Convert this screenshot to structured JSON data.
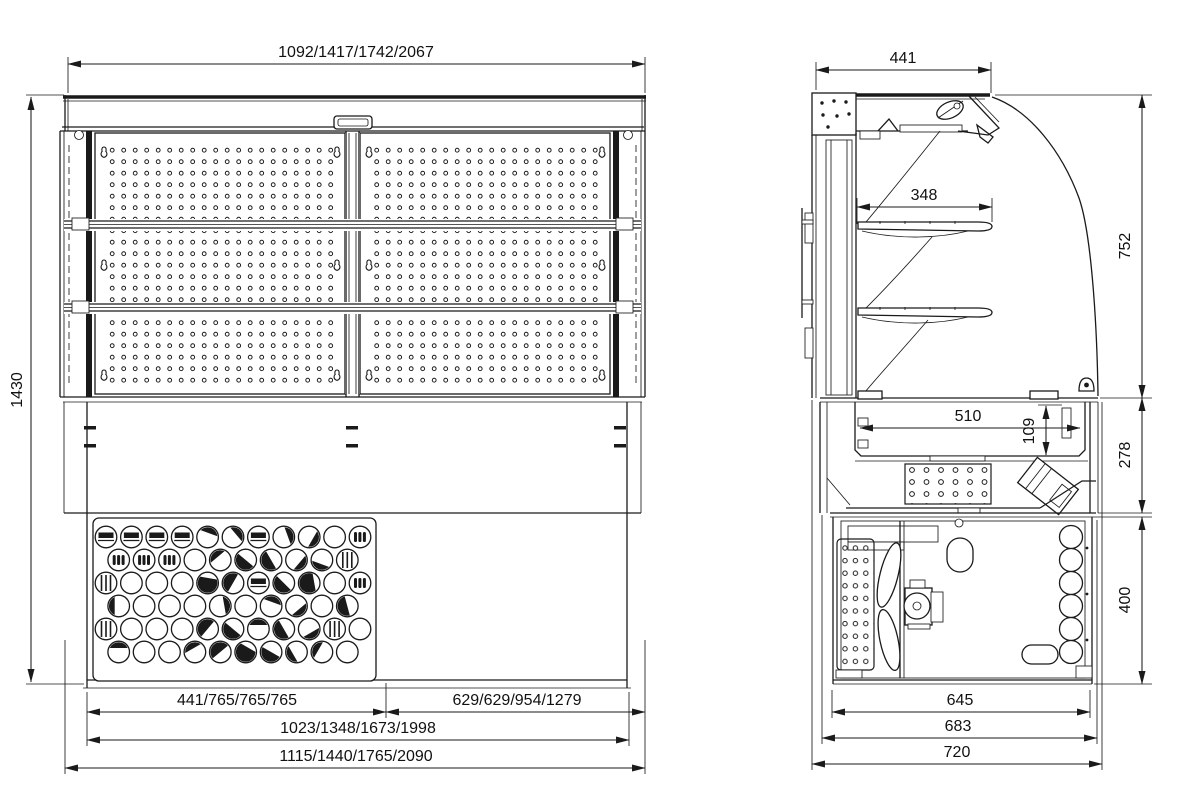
{
  "drawing": {
    "type": "technical-dimension-drawing",
    "subject": "refrigerated display case / drop-in unit, front and side sectional views",
    "background_color": "#ffffff",
    "line_color": "#1a1a1a",
    "views": [
      "front",
      "side-section"
    ]
  },
  "front_view": {
    "dims": {
      "top_width": "1092/1417/1742/2067",
      "height": "1430",
      "bottom_left": "441/765/765/765",
      "bottom_right": "629/629/954/1279",
      "bottom_mid": "1023/1348/1673/1998",
      "bottom_overall": "1115/1440/1765/2090"
    }
  },
  "side_view": {
    "dims": {
      "top_depth": "441",
      "shelf_depth": "348",
      "upper_height": "752",
      "well_height": "278",
      "base_height": "400",
      "well_width": "510",
      "well_depth": "109",
      "bottom_inner": "645",
      "bottom_mid": "683",
      "bottom_overall": "720"
    }
  }
}
